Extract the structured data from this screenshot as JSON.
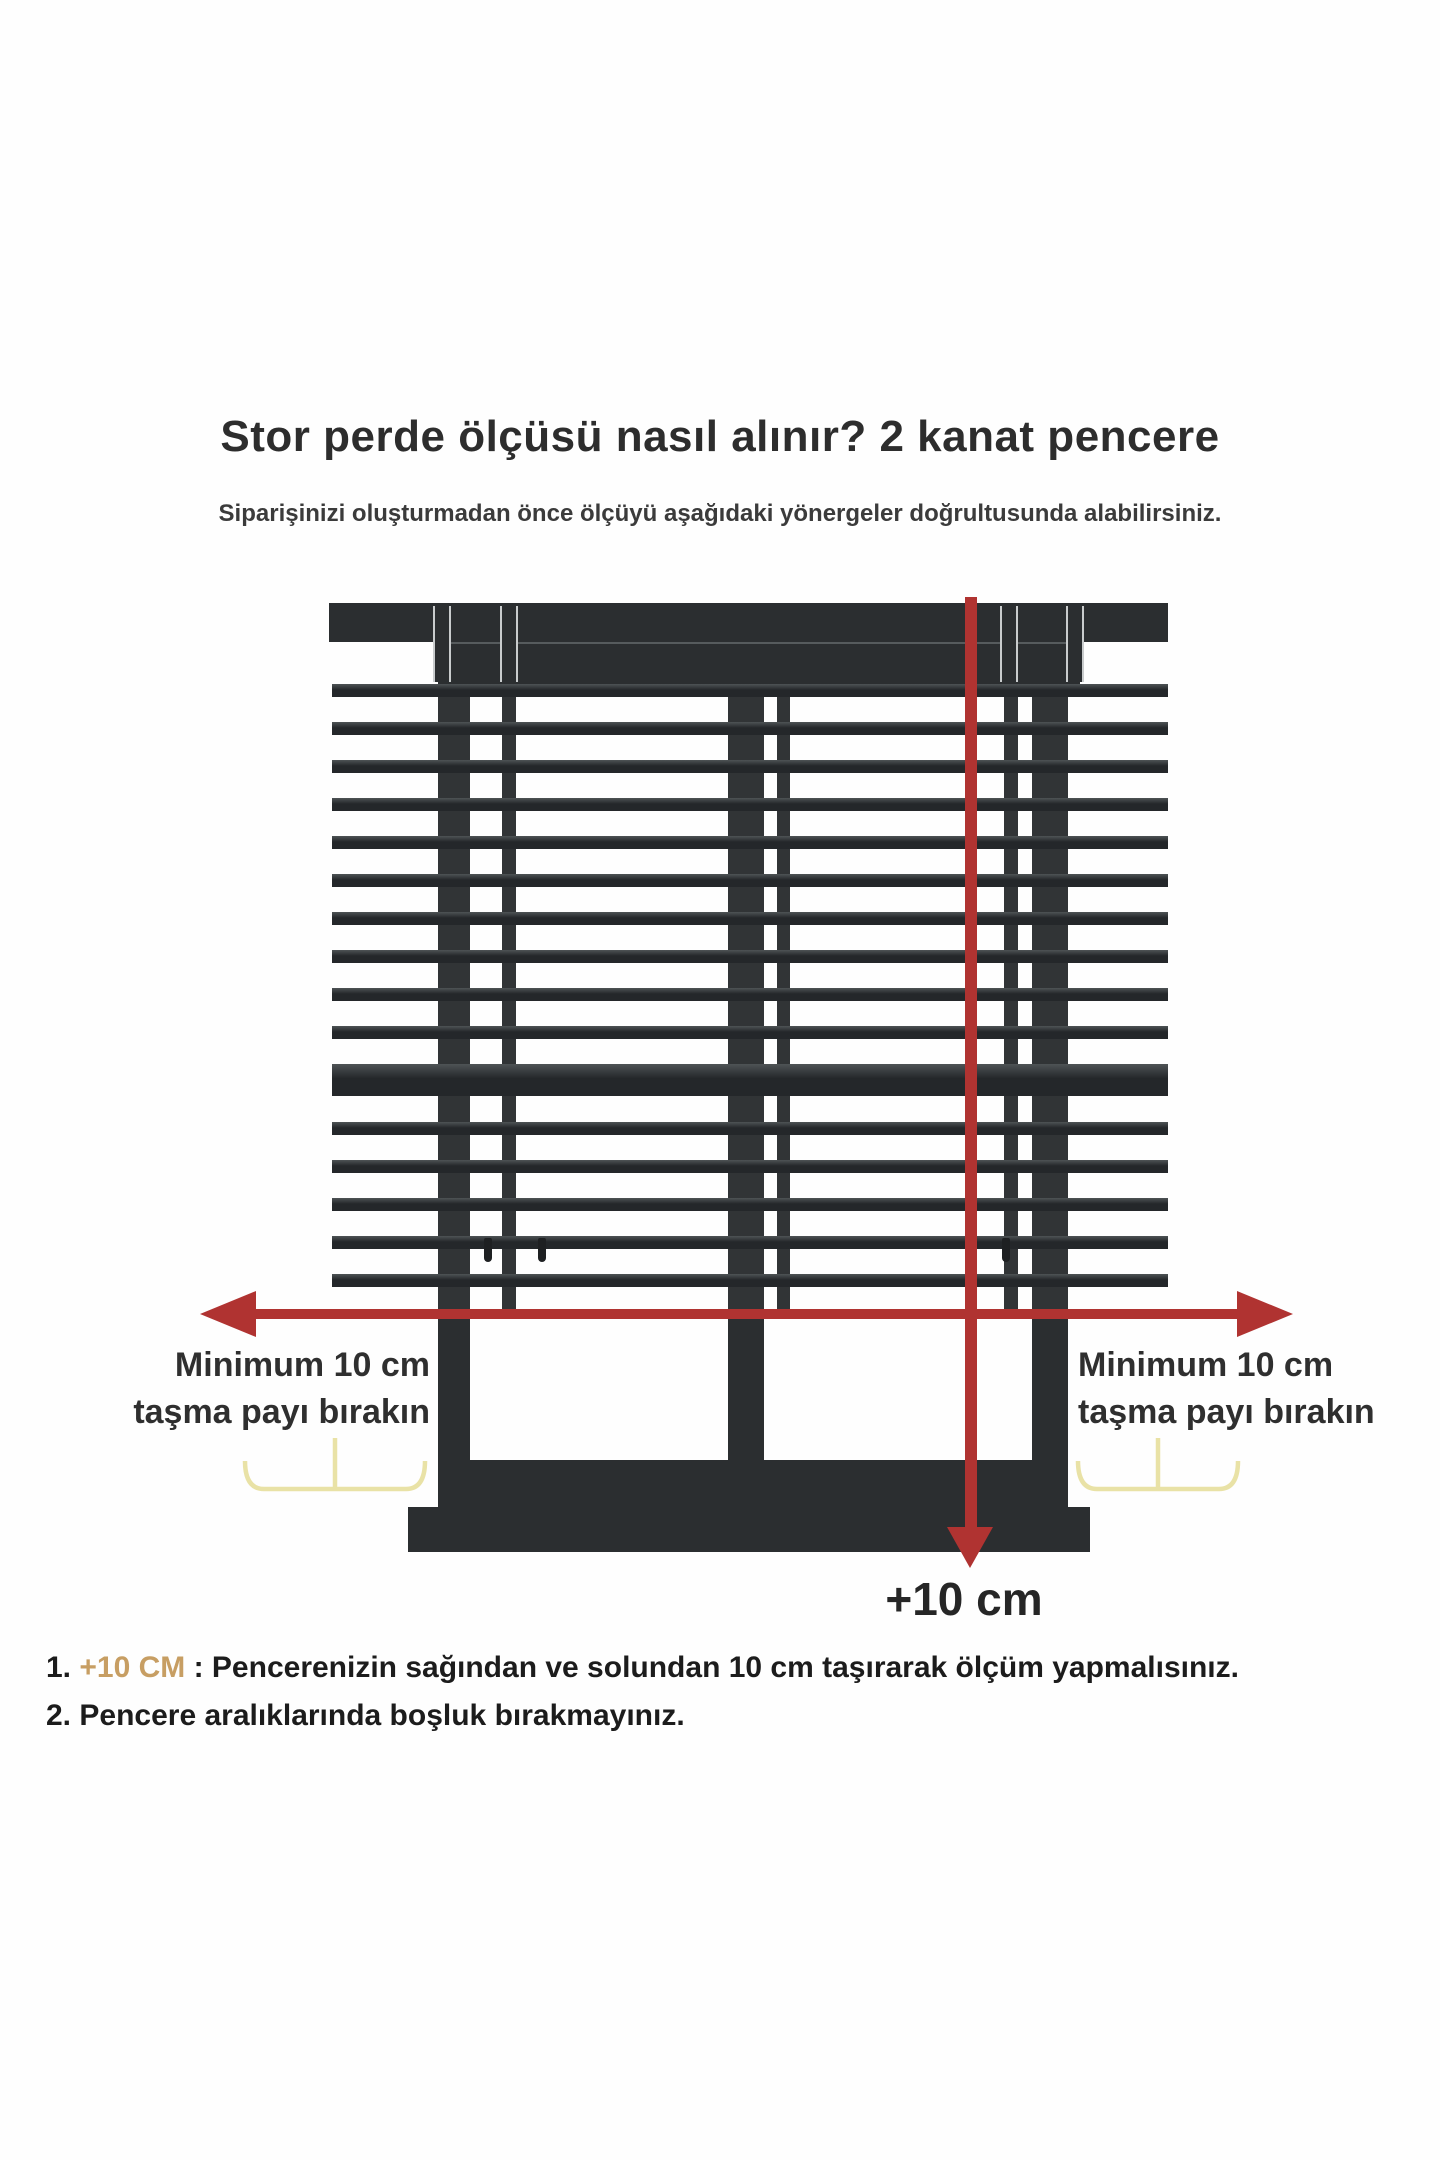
{
  "header": {
    "title": "Stor perde ölçüsü nasıl alınır? 2 kanat pencere",
    "subtitle": "Siparişinizi oluşturmadan önce ölçüyü aşağıdaki yönergeler doğrultusunda alabilirsiniz."
  },
  "diagram": {
    "left_overhang_label": {
      "line1": "Minimum 10 cm",
      "line2": "taşma payı bırakın"
    },
    "right_overhang_label": {
      "line1": "Minimum 10 cm",
      "line2": "taşma payı bırakın"
    },
    "height_arrow_label": "+10 cm",
    "colors": {
      "frame_dark": "#2b2e30",
      "arrow_red": "#b03331",
      "brace_yellow": "#e9e2a6",
      "highlight_tan": "#c79e63"
    },
    "blind": {
      "x": 332,
      "w": 836,
      "first_slat_y": 684,
      "pitch": 38,
      "slat_h": 13,
      "slats_above_rail": 10,
      "rail_y": 1064,
      "rail_h": 32,
      "below_start_y": 1122,
      "slats_below_rail": 5
    }
  },
  "notes": [
    {
      "number": "1.",
      "highlight": "+10 CM",
      "rest": " : Pencerenizin sağından ve solundan 10 cm taşırarak ölçüm yapmalısınız."
    },
    {
      "number": "2.",
      "highlight": "",
      "rest": " Pencere aralıklarında boşluk bırakmayınız."
    }
  ]
}
